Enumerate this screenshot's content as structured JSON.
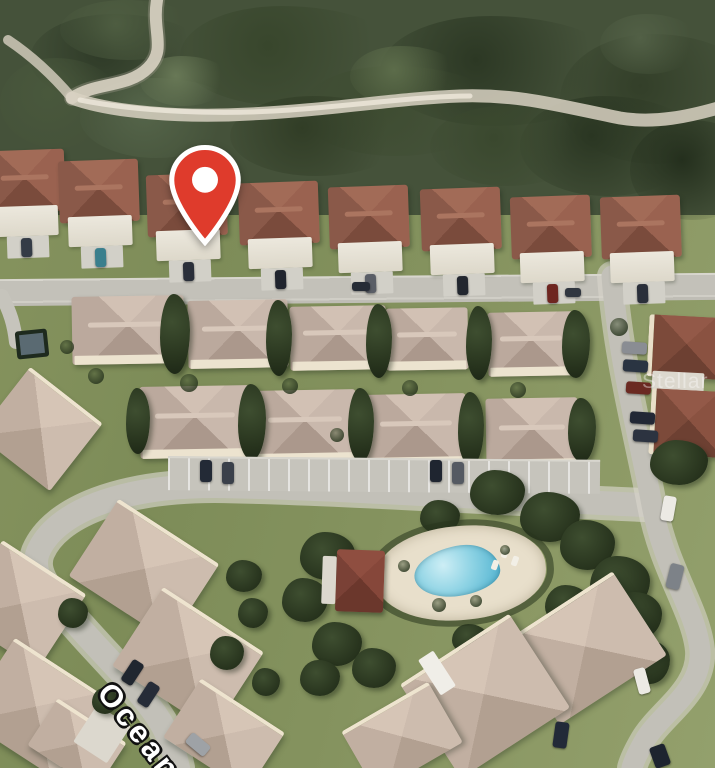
{
  "scene": {
    "type": "satellite-aerial-view",
    "street_label": "Ocean",
    "watermark": "Stellar MLS"
  },
  "marker": {
    "icon": "map-pin-icon",
    "color": "#DF3B2C"
  },
  "colors": {
    "pin_red": "#DF3B2C",
    "pool_water": "#7fcbe0",
    "red_roof": "#8a5949",
    "dark_red_roof": "#7a4136",
    "tan_roof": "#bfaea2",
    "road_gray": "#c3c1b9",
    "grass_green": "#84925e",
    "forest_green": "#45523a",
    "trail_sand": "#d8d1c2",
    "deck_sand": "#e8dfcb"
  }
}
